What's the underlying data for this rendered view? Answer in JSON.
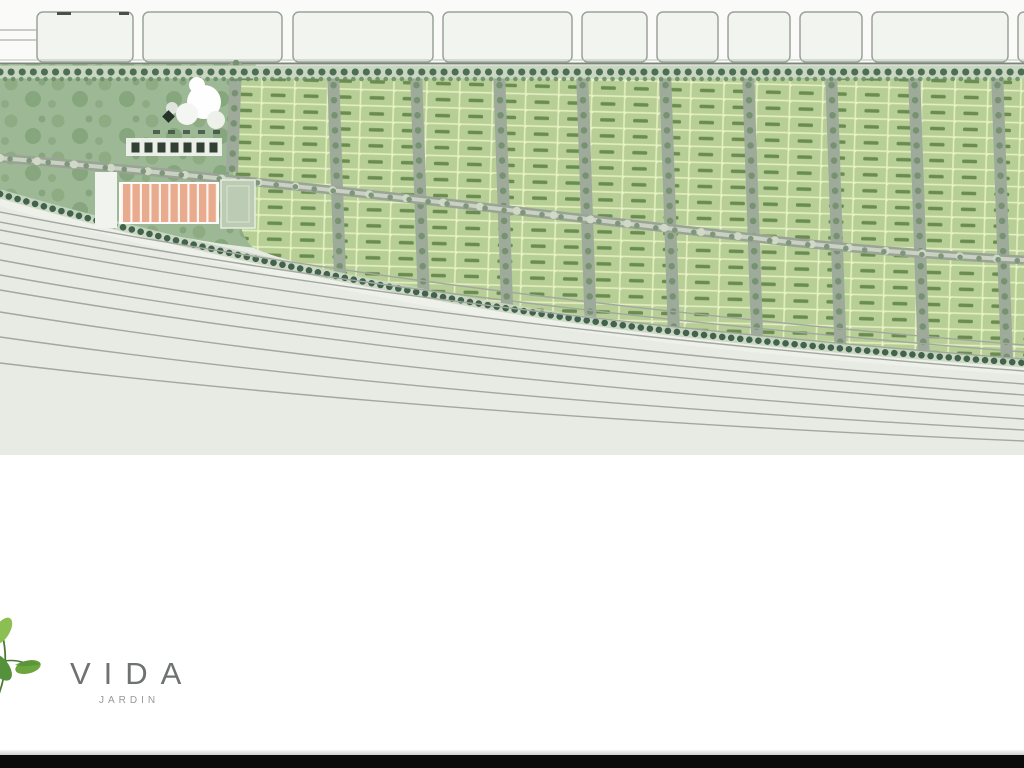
{
  "logo": {
    "title": "VIDA",
    "subtitle": "JARDIN",
    "icon": "leaf-icon"
  },
  "plan": {
    "kind": "residential lot master plan",
    "features": {
      "adjacent_blocks_row": "outlined neighboring parcels along top road",
      "park": "tree-covered green area at west end",
      "lot_grid": "rows of small green lots with dark lot-number marks",
      "main_road": "tree-lined road crossing the development",
      "vertical_streets": "tree-lined block streets",
      "entrance_area": "clubhouse, cabins, parking building, sports court",
      "highway": "multi-lane curved road corridor along south edge"
    }
  },
  "palette": {
    "plan-bg": "#e8eae4",
    "top-band-bg": "#fafbf8",
    "block-fill": "#f2f4ef",
    "block-stroke": "#99a399",
    "park": "#9db895",
    "park-blob": "#86a57b",
    "park-blob2": "#769a6c",
    "lot": "#b7cf97",
    "lot-line": "#e4efbe",
    "lot-dot": "#eef4d9",
    "lot-mark": "#5d8044",
    "street": "#9fab9a",
    "street-tree": "#75906e",
    "road": "#9aa396",
    "road-core": "#c9d1c2",
    "road-tree": "#7e977b",
    "road-tree-light": "#cfd9c6",
    "tree-band": "#c9d6c0",
    "tree-dark": "#4d6e55",
    "tree-dark2": "#41634e",
    "highway-line": "#a2a7a0",
    "salmon": "#e9ab8d",
    "court": "#bccbb3",
    "dark-struct": "#323f33",
    "brand-bg": "#ffffff",
    "brand-title-color": "#6e7370",
    "brand-subtitle-color": "#949a96",
    "leaf-light": "#8cbf52",
    "leaf-mid": "#6da53f",
    "leaf-dark": "#55913a",
    "leaf-stem": "#4c7a33",
    "bottom-bar": "#0b0b0b"
  }
}
